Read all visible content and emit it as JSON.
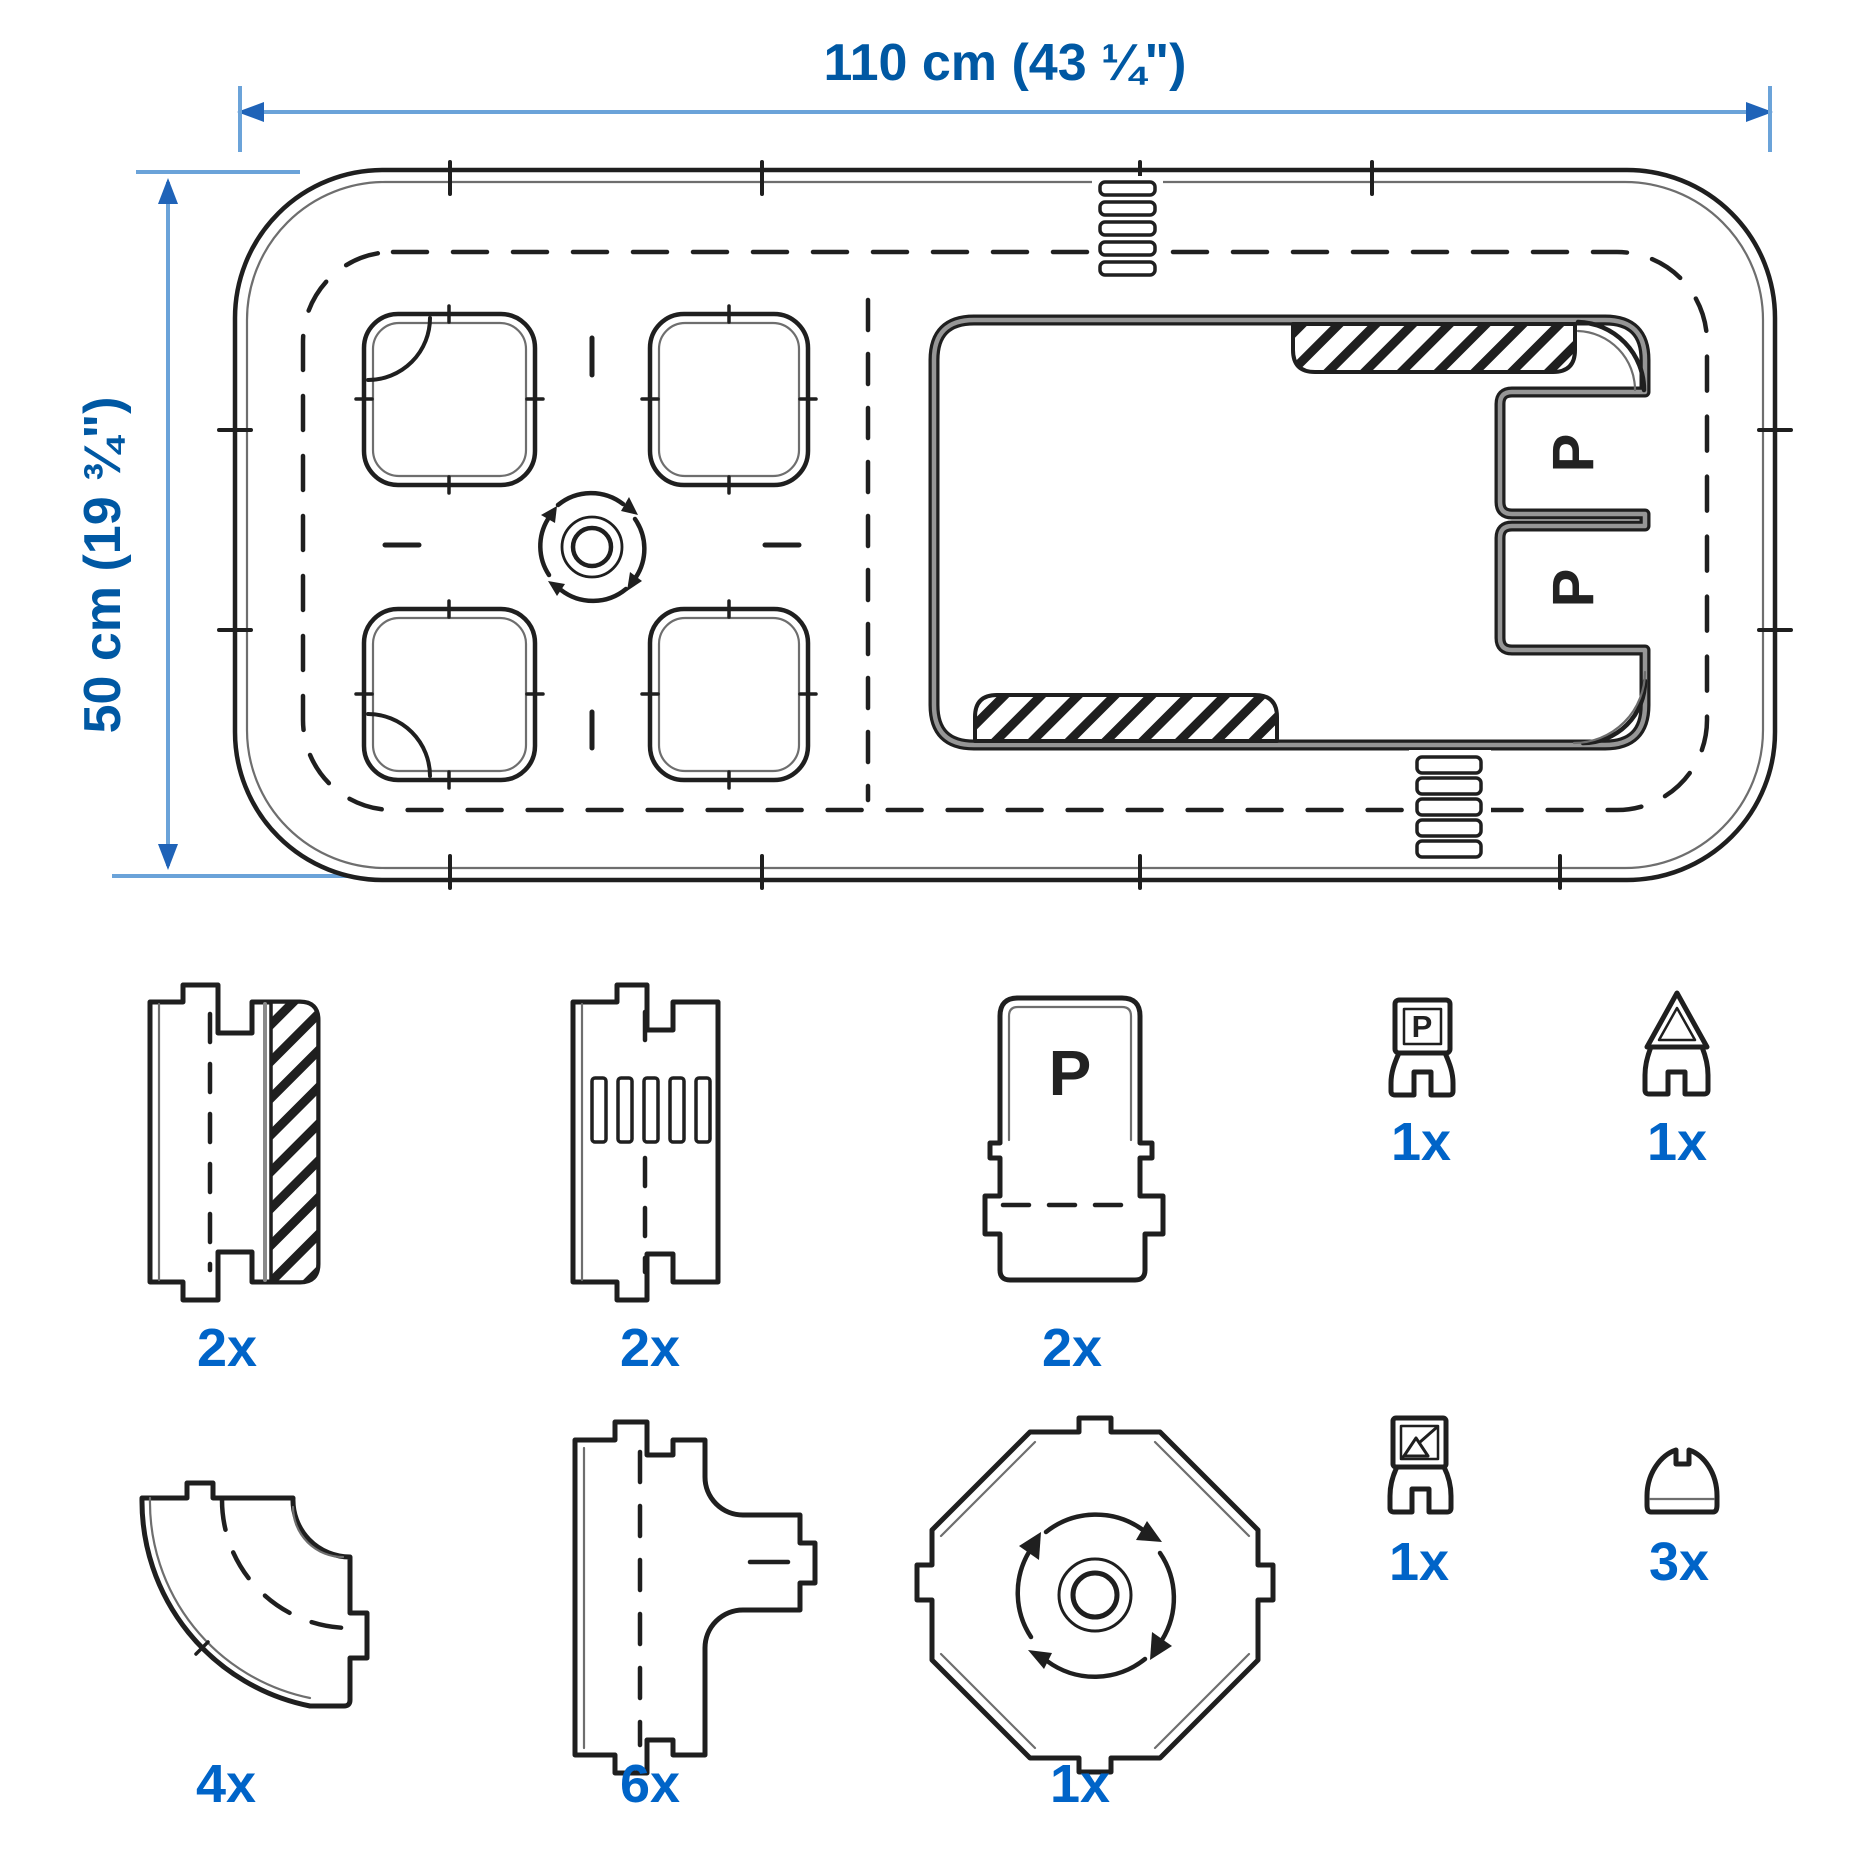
{
  "diagram": {
    "dimensions": {
      "width_label": "110 cm (43 ¼\")",
      "height_label": "50 cm (19 ¾\")"
    },
    "layout": {
      "parking_bay_labels": [
        "P",
        "P"
      ]
    },
    "pieces": {
      "straight_sidewalk": {
        "count": "2x"
      },
      "straight_crosswalk": {
        "count": "2x"
      },
      "parking_bay": {
        "count": "2x",
        "letter": "P"
      },
      "parking_sign": {
        "count": "1x",
        "letter": "P"
      },
      "warning_sign": {
        "count": "1x"
      },
      "curve": {
        "count": "4x"
      },
      "t_junction": {
        "count": "6x"
      },
      "roundabout": {
        "count": "1x"
      },
      "picture_sign": {
        "count": "1x"
      },
      "speed_bump": {
        "count": "3x"
      }
    },
    "colors": {
      "accent_blue": "#0058a3",
      "count_blue": "#0064c8",
      "dimension_line_blue": "#6ba3d9",
      "arrow_blue": "#1f63b8",
      "line_dark": "#1f1f1f"
    }
  }
}
